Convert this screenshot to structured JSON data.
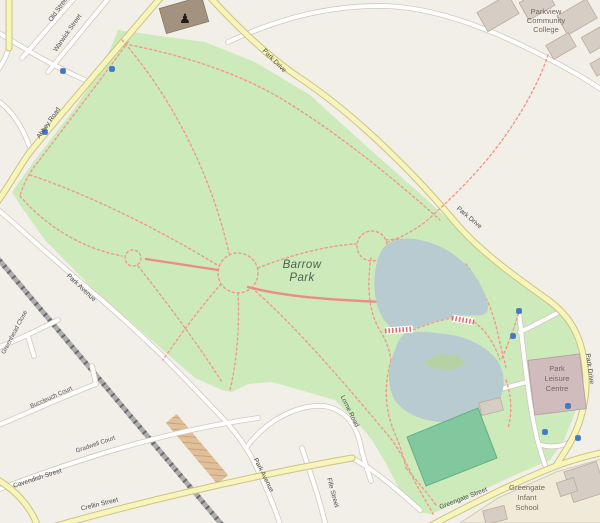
{
  "map": {
    "place_name": "Barrow Park",
    "labels": {
      "park": {
        "l1": "Barrow",
        "l2": "Park"
      },
      "college": {
        "l1": "Parkview",
        "l2": "Community",
        "l3": "College"
      },
      "leisure": {
        "l1": "Park",
        "l2": "Leisure",
        "l3": "Centre"
      },
      "school": {
        "l1": "Greengate",
        "l2": "Infant",
        "l3": "School"
      }
    },
    "streets": {
      "abbey_road": "Abbey Road",
      "park_drive": "Park Drive",
      "warwick_street": "Warwick Street",
      "old_street": "Old Street",
      "park_avenue": "Park Avenue",
      "lorne_road": "Lorne Road",
      "fife_street": "Fife Street",
      "crellin_street": "Crellin Street",
      "cavendish_street": "Cavendish Street",
      "gradwell_court": "Gradwell Court",
      "buccleuch_court": "Buccleuch Court",
      "greenhead_close": "Greenhead Close",
      "greengate_street": "Greengate Street"
    },
    "icons": {
      "monument": "♟",
      "marker": "blue-square-marker"
    },
    "colors": {
      "background_cream": "#f2efe9",
      "park_green": "#cdeabb",
      "pitch_green": "#82c89e",
      "water_blue": "#b7cbd0",
      "island_green": "#b7d2a2",
      "road_yellow": "#f7f5bb",
      "road_white": "#ffffff",
      "footpath_pink": "#ef9a8d",
      "railway_gray": "#adadad",
      "building_gray": "#d6cdc5",
      "leisure_building_pink": "#d0bcbc",
      "school_grounds_beige": "#f0ead9",
      "construction_tan": "#ddbb92",
      "marker_blue": "#3a7ad0"
    }
  }
}
